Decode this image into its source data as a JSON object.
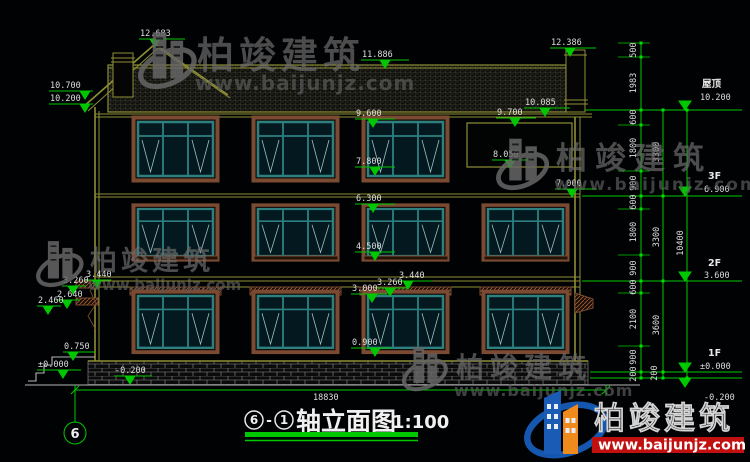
{
  "watermarks": {
    "brand": "柏竣建筑",
    "url": "www.baijunjz.com"
  },
  "brand_logo": {
    "brand": "柏竣建筑",
    "url": "www.baijunjz.com"
  },
  "title_block": {
    "axis_start": "6",
    "separator": "-",
    "axis_end": "1",
    "name": "轴立面图",
    "scale": "1:100"
  },
  "axis_bubble": "6",
  "dims": {
    "total_width": "18830",
    "gable_peak": "12.683",
    "ridge": "11.886",
    "chimney_top": "12.386",
    "left_eave_top": "10.700",
    "left_eave_bottom": "10.200",
    "right_roof_top": "10.085",
    "right_roof_bottom": "9.700",
    "eave": "9.600",
    "f3_sill": "7.800",
    "panel_bottom": "8.050",
    "f3_slab": "7.000",
    "f2_head": "6.300",
    "f2_sill": "4.500",
    "belt_top": "3.440",
    "belt_bottom": "3.260",
    "f1_head": "3.000",
    "f1_sill": "0.900",
    "cap_lower_top": "2.640",
    "cap_lower_bottom": "2.460",
    "porch": "0.750",
    "ground": "±0.000",
    "site": "-0.200"
  },
  "levels": {
    "roof_label": "屋顶",
    "roof": "10.200",
    "f3_label": "3F",
    "f3": "6.900",
    "f2_label": "2F",
    "f2": "3.600",
    "f1_label": "1F",
    "f1": "±0.000",
    "ground": "-0.200"
  },
  "chains": {
    "inner": [
      "500",
      "1983",
      "600",
      "1800",
      "900",
      "600",
      "1800",
      "900",
      "600",
      "2100",
      "900",
      "200"
    ],
    "mid": [
      "3300",
      "3300",
      "3600",
      "200"
    ],
    "outer": [
      "10400"
    ]
  }
}
